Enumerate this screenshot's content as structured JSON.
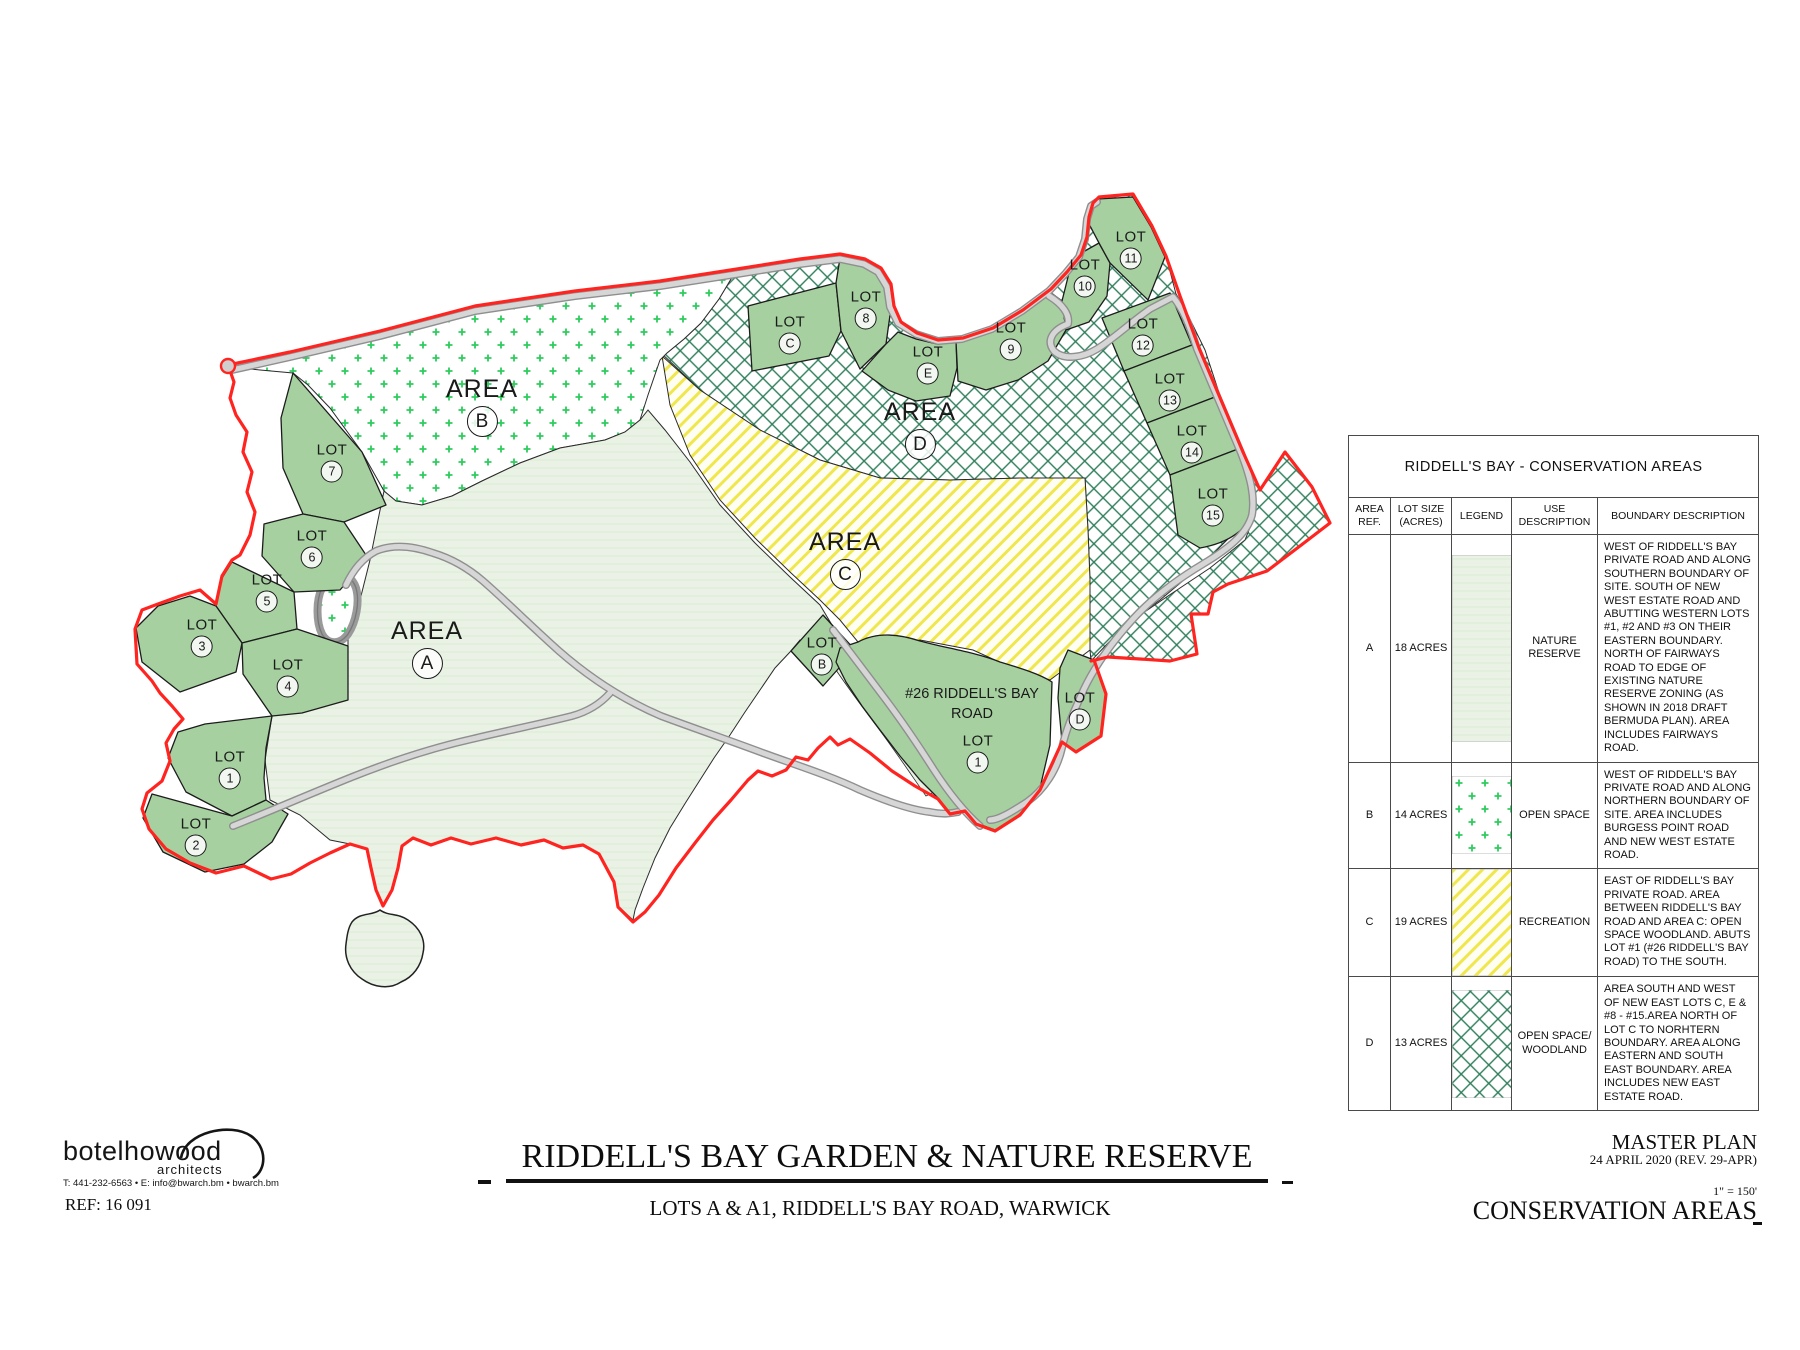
{
  "colors": {
    "lot_green": "#a6d0a0",
    "area_a": "#e9f2e4",
    "dot_green": "#2ecc5e",
    "hatch_yellow": "#f0e74c",
    "cross_green": "#2e7d5a",
    "boundary_red": "#ff2420",
    "road_gray": "#d5d5d5"
  },
  "map": {
    "labels": [
      {
        "t": "area",
        "word": "AREA",
        "c": "A",
        "x": 427,
        "y": 648
      },
      {
        "t": "area",
        "word": "AREA",
        "c": "B",
        "x": 482,
        "y": 406
      },
      {
        "t": "area",
        "word": "AREA",
        "c": "C",
        "x": 845,
        "y": 559
      },
      {
        "t": "area",
        "word": "AREA",
        "c": "D",
        "x": 920,
        "y": 429
      },
      {
        "t": "lot",
        "word": "LOT",
        "c": "7",
        "x": 332,
        "y": 462
      },
      {
        "t": "lot",
        "word": "LOT",
        "c": "6",
        "x": 312,
        "y": 548
      },
      {
        "t": "lot",
        "word": "LOT",
        "c": "5",
        "x": 267,
        "y": 592
      },
      {
        "t": "lot",
        "word": "LOT",
        "c": "3",
        "x": 202,
        "y": 637
      },
      {
        "t": "lot",
        "word": "LOT",
        "c": "4",
        "x": 288,
        "y": 677
      },
      {
        "t": "lot",
        "word": "LOT",
        "c": "1",
        "x": 230,
        "y": 769
      },
      {
        "t": "lot",
        "word": "LOT",
        "c": "2",
        "x": 196,
        "y": 836
      },
      {
        "t": "lot",
        "word": "LOT",
        "c": "C",
        "x": 790,
        "y": 334
      },
      {
        "t": "lot",
        "word": "LOT",
        "c": "8",
        "x": 866,
        "y": 309
      },
      {
        "t": "lot",
        "word": "LOT",
        "c": "E",
        "x": 928,
        "y": 364
      },
      {
        "t": "lot",
        "word": "LOT",
        "c": "9",
        "x": 1011,
        "y": 340
      },
      {
        "t": "lot",
        "word": "LOT",
        "c": "10",
        "x": 1085,
        "y": 277
      },
      {
        "t": "lot",
        "word": "LOT",
        "c": "11",
        "x": 1131,
        "y": 249
      },
      {
        "t": "lot",
        "word": "LOT",
        "c": "12",
        "x": 1143,
        "y": 336
      },
      {
        "t": "lot",
        "word": "LOT",
        "c": "13",
        "x": 1170,
        "y": 391
      },
      {
        "t": "lot",
        "word": "LOT",
        "c": "14",
        "x": 1192,
        "y": 443
      },
      {
        "t": "lot",
        "word": "LOT",
        "c": "15",
        "x": 1213,
        "y": 506
      },
      {
        "t": "lot",
        "word": "LOT",
        "c": "B",
        "x": 822,
        "y": 655
      },
      {
        "t": "lot",
        "word": "LOT",
        "c": "D",
        "x": 1080,
        "y": 710
      },
      {
        "t": "lot",
        "word": "LOT",
        "c": "1",
        "x": 978,
        "y": 753
      },
      {
        "t": "addr",
        "lines": [
          "#26 RIDDELL'S BAY",
          "ROAD"
        ],
        "x": 972,
        "y": 704
      }
    ]
  },
  "table": {
    "title": "RIDDELL'S BAY - CONSERVATION AREAS",
    "headers": [
      "AREA REF.",
      "LOT SIZE (ACRES)",
      "LEGEND",
      "USE DESCRIPTION",
      "BOUNDARY DESCRIPTION"
    ],
    "rows": [
      {
        "ref": "A",
        "size": "18 ACRES",
        "legend": "nature-reserve",
        "use": "NATURE RESERVE",
        "boundary": "WEST OF RIDDELL'S BAY PRIVATE ROAD AND ALONG SOUTHERN BOUNDARY OF SITE. SOUTH OF NEW WEST ESTATE ROAD AND ABUTTING WESTERN LOTS #1, #2 AND #3 ON THEIR EASTERN BOUNDARY. NORTH OF FAIRWAYS ROAD TO EDGE OF EXISTING NATURE RESERVE ZONING (AS SHOWN IN 2018 DRAFT BERMUDA PLAN). AREA INCLUDES FAIRWAYS ROAD."
      },
      {
        "ref": "B",
        "size": "14 ACRES",
        "legend": "open-space",
        "use": "OPEN SPACE",
        "boundary": "WEST OF RIDDELL'S BAY PRIVATE ROAD AND ALONG NORTHERN BOUNDARY OF SITE. AREA INCLUDES BURGESS POINT ROAD AND NEW WEST ESTATE ROAD."
      },
      {
        "ref": "C",
        "size": "19 ACRES",
        "legend": "recreation",
        "use": "RECREATION",
        "boundary": "EAST OF RIDDELL'S BAY PRIVATE ROAD. AREA BETWEEN RIDDELL'S BAY ROAD AND AREA C: OPEN SPACE WOODLAND. ABUTS LOT #1 (#26 RIDDELL'S BAY ROAD) TO THE SOUTH."
      },
      {
        "ref": "D",
        "size": "13 ACRES",
        "legend": "open-space-woodland",
        "use": "OPEN SPACE/ WOODLAND",
        "boundary": "AREA SOUTH AND WEST OF NEW EAST LOTS C, E & #8 - #15.AREA NORTH OF LOT C TO NORHTERN BOUNDARY. AREA ALONG EASTERN AND SOUTH EAST BOUNDARY. AREA INCLUDES NEW EAST ESTATE ROAD."
      }
    ]
  },
  "titleblock": {
    "firm": {
      "name": "botelhowood",
      "discipline": "architects",
      "contact": "T: 441-232-6563 • E: info@bwarch.bm • bwarch.bm",
      "ref": "REF: 16 091"
    },
    "title": "RIDDELL'S BAY GARDEN & NATURE RESERVE",
    "subtitle": "LOTS A & A1, RIDDELL'S BAY ROAD, WARWICK",
    "plan": {
      "name": "MASTER PLAN",
      "date": "24 APRIL 2020 (REV. 29-APR)",
      "scale": "1\" = 150'",
      "sheet": "CONSERVATION AREAS"
    }
  }
}
